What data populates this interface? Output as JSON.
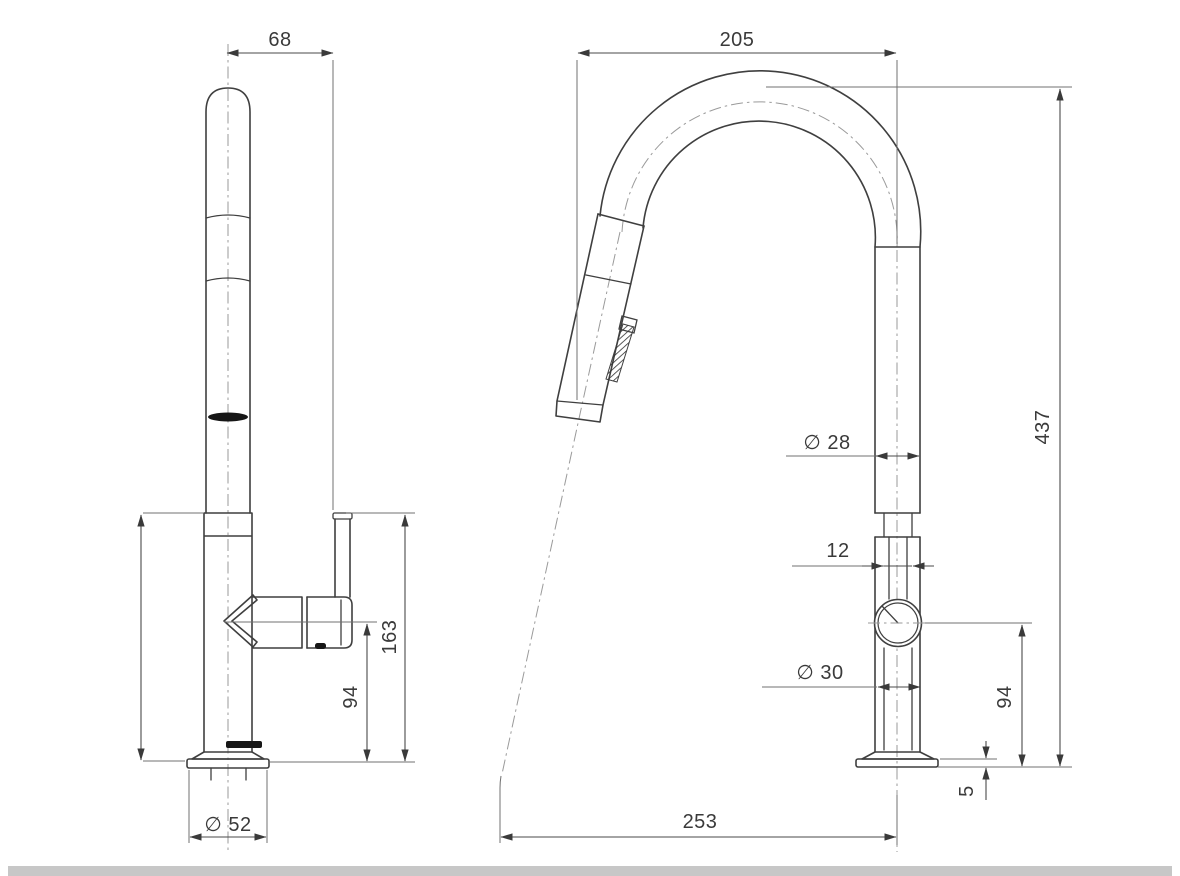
{
  "page": {
    "background": "#ffffff",
    "line_color": "#3f3f3f",
    "dim_text_color": "#3a3a3a",
    "edge_strip_color": "#c7c7c7"
  },
  "drawing": {
    "type": "technical-dimension-drawing",
    "subject": "pull-out kitchen sink mixer tap, two orthographic views",
    "dimensions": {
      "front": {
        "spout_to_handle_width": "68",
        "height_to_handle_top": "163",
        "handle_centre_height": "94",
        "base_diameter": "∅ 52"
      },
      "side": {
        "spout_reach": "205",
        "overall_height": "437",
        "spout_tube_diameter": "∅ 28",
        "cartridge_slot_width": "12",
        "body_diameter": "∅ 30",
        "mixer_centre_height": "94",
        "base_plate_thickness": "5",
        "spray_projection": "253"
      }
    }
  }
}
